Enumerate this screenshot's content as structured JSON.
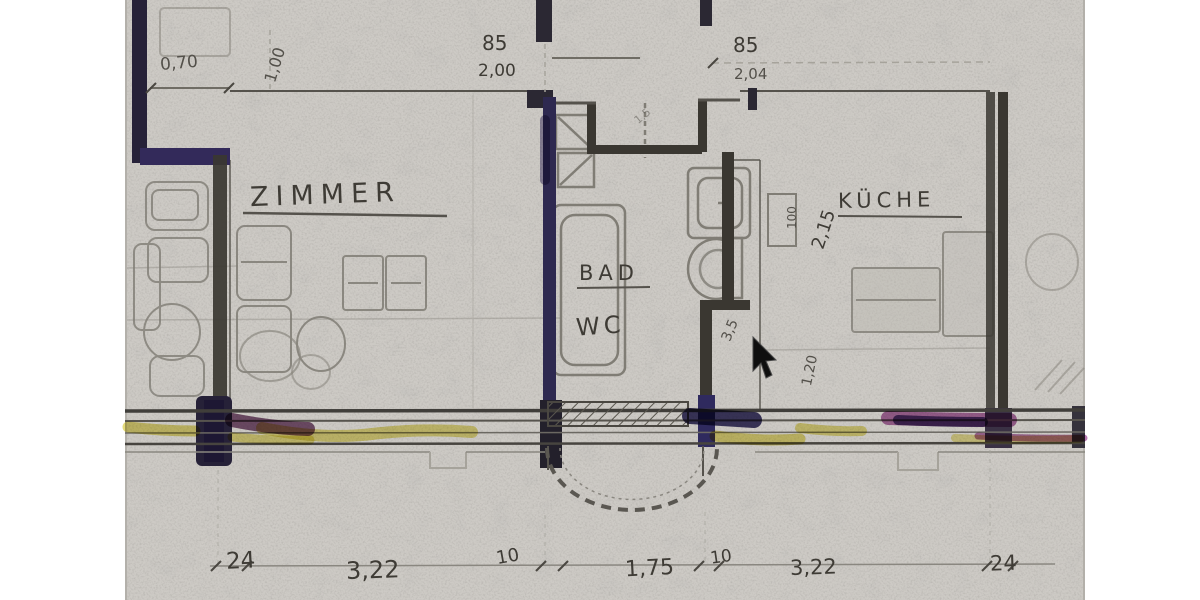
{
  "scan": {
    "kind": "scanned hand-drawn architectural floor plan",
    "language": "German",
    "page_background": "#ffffff"
  },
  "rooms": {
    "zimmer": "ZIMMER",
    "bad": "BAD",
    "wc": "WC",
    "kueche": "KÜCHE"
  },
  "dims": {
    "top_left_w": "0,70",
    "top_left_h": "1,00",
    "top_mid_a": "85",
    "top_mid_b": "2,00",
    "top_right_a": "85",
    "top_right_b": "2,04",
    "sink": "100",
    "kitchen_depth": "2,15",
    "duct": "3,5",
    "kitchen_len": "1,20",
    "faint_note": "1,5",
    "bottom": [
      "24",
      "3,22",
      "10",
      "1,75",
      "10",
      "3,22",
      "24"
    ]
  },
  "colors": {
    "paper": "#cdcac5",
    "ink": "#3e3b35",
    "pencil": "#807d75",
    "wall_ink": "#3a3731",
    "wall_dark": "#262138",
    "wall_purple": "#332a5a",
    "bath_wall": "#2e2950",
    "hl_yellow": "#ddd150",
    "hl_navy": "#2f2a5e",
    "hl_maroon": "#63325c",
    "hl_magenta": "#a04d97",
    "hl_purple": "#483a78"
  },
  "cursor": {
    "shape": "arrow",
    "x": 753,
    "y": 337
  }
}
